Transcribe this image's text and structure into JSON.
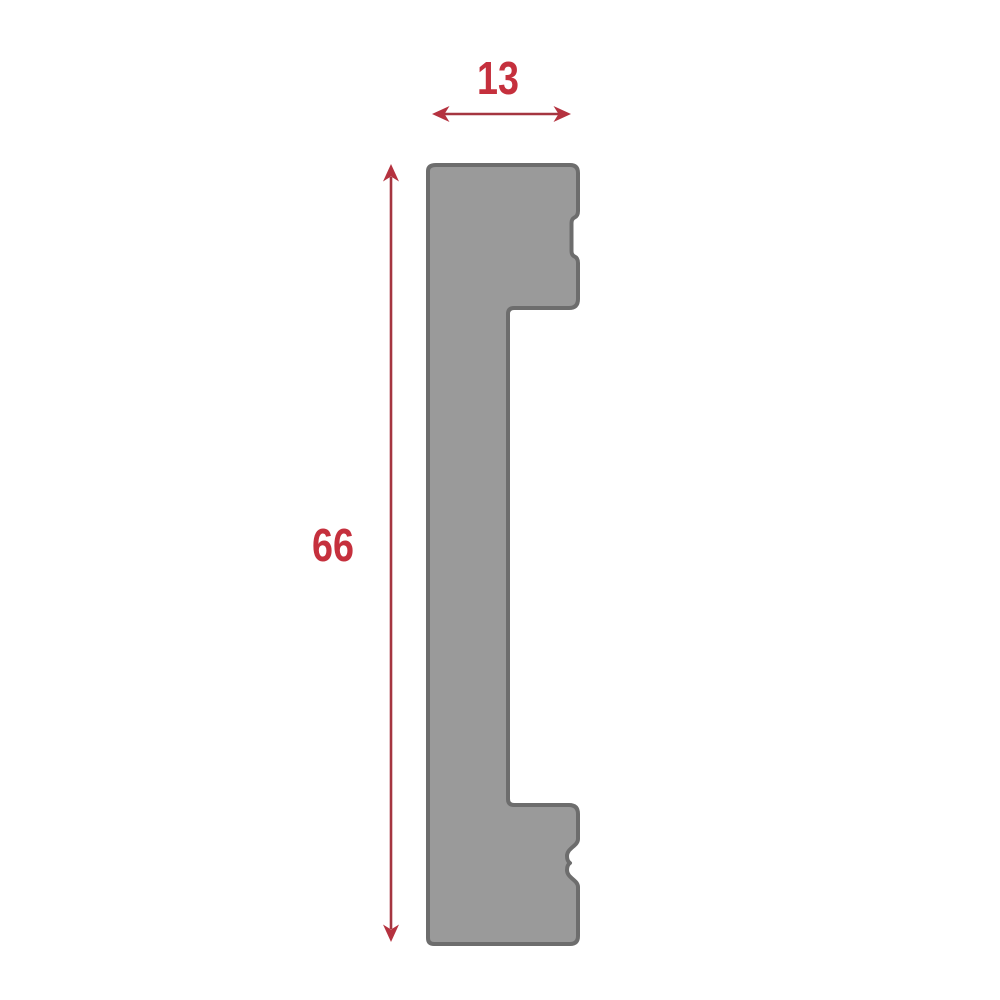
{
  "diagram": {
    "kind": "profile-cross-section",
    "description": "Side cross-section profile of a moulding/skirting strip with two clip notches on the right edge"
  },
  "colors": {
    "background": "#ffffff",
    "profile_fill": "#9a9a9a",
    "profile_stroke": "#6d6d6d",
    "dimension_line": "#a53540",
    "dimension_arrow": "#b5323f",
    "dimension_text": "#c5303d"
  },
  "profile": {
    "name": "moulding-profile-shape",
    "path": "M 436 165 L 570 165 Q 578 165 578 173 L 578 211 Q 578 216 574.5 217.5 Q 571.5 219 571.5 223 L 571.5 251 Q 571.5 255 574.5 256.5 Q 578 258 578 263 L 578 299 Q 578 308 569 308 L 514 308 Q 508 308 508 314 L 508 799 Q 508 805 514 805 L 569 805 Q 578 805 578 814 L 578 839 C 578 846 567 848 567 856 Q 567 861 570 863 Q 567 865 567 870 C 567 878 578 880 578 887 L 578 936 Q 578 944 570 944 L 434 944 Q 428 944 428 938 L 428 171 Q 428 165 436 165 Z"
  },
  "dimensions": {
    "width": {
      "label": "13"
    },
    "height": {
      "label": "66"
    }
  }
}
